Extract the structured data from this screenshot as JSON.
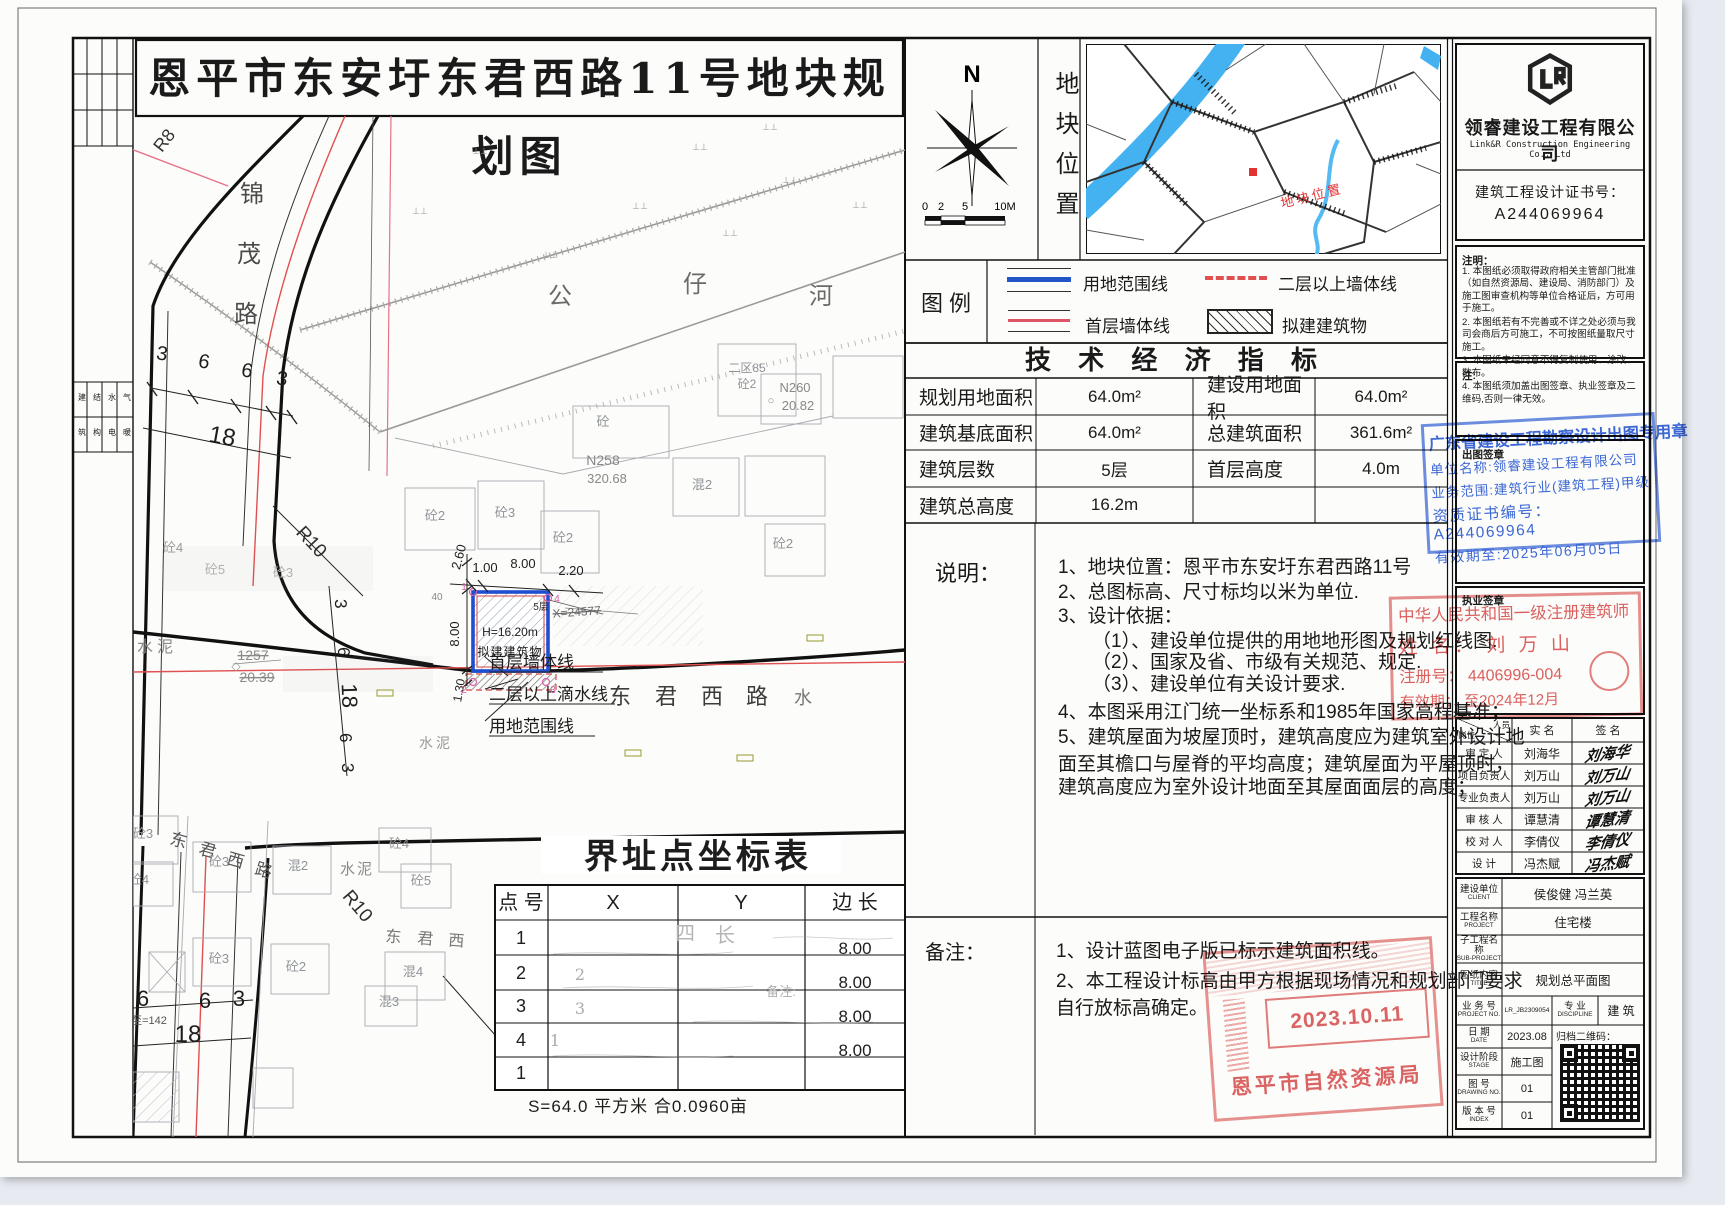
{
  "title": "恩平市东安圩东君西路11号地块规划图",
  "compass": {
    "north": "N",
    "scale_labels": [
      "0",
      "2",
      "5",
      "10M"
    ]
  },
  "location_panel": {
    "label_vertical": "地块位置",
    "marker_text": "地块位置"
  },
  "legend": {
    "title": "图  例",
    "items": [
      "用地范围线",
      "二层以上墙体线",
      "首层墙体线",
      "拟建建筑物"
    ]
  },
  "indicators": {
    "title": "技 术 经 济 指 标",
    "rows": [
      [
        "规划用地面积",
        "64.0m²",
        "建设用地面积",
        "64.0m²"
      ],
      [
        "建筑基底面积",
        "64.0m²",
        "总建筑面积",
        "361.6m²"
      ],
      [
        "建筑层数",
        "5层",
        "首层高度",
        "4.0m"
      ],
      [
        "建筑总高度",
        "16.2m",
        "",
        ""
      ]
    ]
  },
  "shuoming": {
    "label": "说明：",
    "lines": [
      "1、地块位置：恩平市东安圩东君西路11号",
      "2、总图标高、尺寸标均以米为单位.",
      "3、设计依据：",
      "（1）、建设单位提供的用地地形图及规划红线图.",
      "（2）、国家及省、市级有关规范、规定.",
      "（3）、建设单位有关设计要求.",
      "4、本图采用江门统一坐标系和1985年国家高程基准；",
      "5、建筑屋面为坡屋顶时，建筑高度应为建筑室外设计地",
      "面至其檐口与屋脊的平均高度；建筑屋面为平屋顶时，",
      "建筑高度应为室外设计地面至其屋面面层的高度；"
    ]
  },
  "beizhu": {
    "label": "备注：",
    "lines": [
      "1、设计蓝图电子版已标示建筑面积线。",
      "2、本工程设计标高由甲方根据现场情况和规划部门要求",
      "自行放标高确定。"
    ]
  },
  "company": {
    "name": "领睿建设工程有限公司",
    "name_en": "Link&R Construction Engineering Co., Ltd",
    "cert_label": "建筑工程设计证书号：",
    "cert_no": "A244069964"
  },
  "zhuming": {
    "label": "注明：",
    "lines": [
      "1. 本图纸必须取得政府相关主管部门批准（如自然资源局、建设局、消防部门）及施工图审查机构等单位合格证后，方可用于施工。",
      "2. 本图纸若有不完善或不详之处必须与我司会商后方可施工，不可按图纸量取尺寸施工。",
      "3. 本图纸未经同意不得复制使用、涂改、散布。",
      "4. 本图纸须加盖出图签章、执业签章及二维码,否则一律无效。"
    ]
  },
  "zhu": {
    "label": "注:"
  },
  "chutu": {
    "label": "出图签章",
    "stamp": [
      "广东省建设工程勘察设计出图专用章",
      "单位名称:领睿建设工程有限公司",
      "业务范围:建筑行业(建筑工程)甲级",
      "资质证书编号：A244069964",
      "有效期至:2025年06月05日"
    ]
  },
  "zhiye": {
    "label": "执业签章",
    "stamp": [
      "中华人民共和国一级注册建筑师",
      "姓 名： 刘 万 山",
      "注册号： 4406996-004",
      "有效期： 至2024年12月"
    ]
  },
  "personnel": {
    "header": {
      "pos": "岗位",
      "person": "人员",
      "name": "实 名",
      "sign": "签 名"
    },
    "rows": [
      [
        "审 定 人",
        "刘海华"
      ],
      [
        "项目负责人",
        "刘万山"
      ],
      [
        "专业负责人",
        "刘万山"
      ],
      [
        "审 核 人",
        "谭慧清"
      ],
      [
        "校 对 人",
        "李倩仪"
      ],
      [
        "设  计",
        "冯杰赋"
      ]
    ]
  },
  "project": {
    "rows": [
      {
        "zh": "建设单位",
        "en": "CLIENT",
        "val": "侯俊健  冯兰英"
      },
      {
        "zh": "工程名称",
        "en": "PROJECT",
        "val": "住宅楼"
      },
      {
        "zh": "子工程名称",
        "en": "SUB-PROJECT",
        "val": ""
      },
      {
        "zh": "图纸内容",
        "en": "TITLE",
        "val": "规划总平面图"
      }
    ],
    "no_zh": "业 务 号",
    "no_en": "PROJECT NO.",
    "no_val": "LR_JB2309054",
    "disc_zh": "专  业",
    "disc_en": "DISCIPLINE",
    "disc_val": "建  筑",
    "date_zh": "日  期",
    "date_en": "DATE",
    "date_val": "2023.08",
    "qr_label": "归档二维码：",
    "stage_zh": "设计阶段",
    "stage_en": "STAGE",
    "stage_val": "施工图",
    "dwg_zh": "图  号",
    "dwg_en": "DRAWING NO.",
    "dwg_val": "01",
    "idx_zh": "版 本 号",
    "idx_en": "INDEX",
    "idx_val": "01"
  },
  "approval_stamp": {
    "date": "2023.10.11",
    "org": "恩平市自然资源局"
  },
  "margin_strip": {
    "chars": [
      [
        "建",
        "筑"
      ],
      [
        "结",
        "构"
      ],
      [
        "水",
        "电"
      ],
      [
        "气",
        "暖"
      ]
    ]
  },
  "coord_table": {
    "title": "界址点坐标表",
    "headers": [
      "点 号",
      "X",
      "Y",
      "边 长"
    ],
    "points": [
      "1",
      "2",
      "3",
      "4",
      "1"
    ],
    "lengths": [
      "8.00",
      "8.00",
      "8.00",
      "8.00"
    ],
    "ghost_x": [
      "2",
      "3",
      "1"
    ],
    "ghost_marks": [
      "四",
      "长",
      "备注:"
    ],
    "footer": "S=64.0 平方米 合0.0960亩"
  },
  "map": {
    "labels": [
      {
        "t": "锦",
        "x": 119,
        "y": 86,
        "s": 24,
        "c": "#4a4a4a"
      },
      {
        "t": "茂",
        "x": 116,
        "y": 146,
        "s": 24,
        "c": "#4a4a4a"
      },
      {
        "t": "路",
        "x": 113,
        "y": 206,
        "s": 24,
        "c": "#4a4a4a"
      },
      {
        "t": "R8",
        "x": 36,
        "y": 28,
        "s": 18,
        "r": -52,
        "c": "#333333"
      },
      {
        "t": "公",
        "x": 427,
        "y": 188,
        "s": 24,
        "c": "#6a6a6a"
      },
      {
        "t": "仔",
        "x": 562,
        "y": 176,
        "s": 24,
        "c": "#6a6a6a"
      },
      {
        "t": "河",
        "x": 688,
        "y": 188,
        "s": 24,
        "c": "#6a6a6a"
      },
      {
        "t": "R10",
        "x": 174,
        "y": 430,
        "s": 19,
        "r": 47,
        "c": "#2e2e2e"
      },
      {
        "t": "R10",
        "x": 220,
        "y": 794,
        "s": 19,
        "r": 50,
        "c": "#2e2e2e"
      },
      {
        "t": "3",
        "x": 28,
        "y": 244,
        "s": 20,
        "r": 10
      },
      {
        "t": "6",
        "x": 70,
        "y": 252,
        "s": 20,
        "r": 10
      },
      {
        "t": "6",
        "x": 113,
        "y": 261,
        "s": 20,
        "r": 10
      },
      {
        "t": "3",
        "x": 148,
        "y": 269,
        "s": 20,
        "r": 10
      },
      {
        "t": "18",
        "x": 88,
        "y": 328,
        "s": 24,
        "r": 10
      },
      {
        "t": "3",
        "x": 202,
        "y": 488,
        "s": 17,
        "r": 88
      },
      {
        "t": "6",
        "x": 205,
        "y": 536,
        "s": 17,
        "r": 88
      },
      {
        "t": "18",
        "x": 209,
        "y": 580,
        "s": 22,
        "r": 88
      },
      {
        "t": "6",
        "x": 207,
        "y": 622,
        "s": 17,
        "r": 88
      },
      {
        "t": "3",
        "x": 209,
        "y": 652,
        "s": 17,
        "r": 88
      },
      {
        "t": "6",
        "x": 10,
        "y": 890,
        "s": 22
      },
      {
        "t": "6",
        "x": 72,
        "y": 892,
        "s": 22
      },
      {
        "t": "3",
        "x": 106,
        "y": 890,
        "s": 22
      },
      {
        "t": "18",
        "x": 55,
        "y": 926,
        "s": 24
      },
      {
        "t": "至=142",
        "x": 16,
        "y": 908,
        "s": 11,
        "c": "#555555"
      },
      {
        "t": "东",
        "x": 487,
        "y": 588,
        "s": 22,
        "c": "#3c3c3c"
      },
      {
        "t": "君",
        "x": 533,
        "y": 588,
        "s": 22,
        "c": "#3c3c3c"
      },
      {
        "t": "西",
        "x": 579,
        "y": 588,
        "s": 22,
        "c": "#3c3c3c"
      },
      {
        "t": "路",
        "x": 624,
        "y": 588,
        "s": 22,
        "c": "#3c3c3c"
      },
      {
        "t": "水",
        "x": 670,
        "y": 588,
        "s": 18,
        "c": "#777777"
      },
      {
        "t": "东",
        "x": 44,
        "y": 730,
        "s": 17,
        "r": 16,
        "c": "#555555"
      },
      {
        "t": "君",
        "x": 73,
        "y": 740,
        "s": 17,
        "r": 16,
        "c": "#555555"
      },
      {
        "t": "西",
        "x": 101,
        "y": 750,
        "s": 17,
        "r": 16,
        "c": "#555555"
      },
      {
        "t": "路",
        "x": 129,
        "y": 760,
        "s": 17,
        "r": 16,
        "c": "#555555"
      },
      {
        "t": "东",
        "x": 260,
        "y": 826,
        "s": 16,
        "r": 4,
        "c": "#777777"
      },
      {
        "t": "君",
        "x": 292,
        "y": 828,
        "s": 16,
        "r": 4,
        "c": "#777777"
      },
      {
        "t": "西",
        "x": 323,
        "y": 830,
        "s": 16,
        "r": 4,
        "c": "#777777"
      },
      {
        "t": "1257",
        "x": 120,
        "y": 544,
        "s": 14,
        "c": "#8a8a8a",
        "td": 1
      },
      {
        "t": "20.39",
        "x": 124,
        "y": 566,
        "s": 14,
        "c": "#8a8a8a",
        "td": 1
      },
      {
        "t": "◇",
        "x": 103,
        "y": 554,
        "s": 12,
        "c": "#999999"
      },
      {
        "t": "水泥",
        "x": 24,
        "y": 536,
        "s": 16,
        "c": "#8a8a8a",
        "ls": 4
      },
      {
        "t": "水泥",
        "x": 303,
        "y": 632,
        "s": 14,
        "c": "#9a9a9a",
        "ls": 3
      },
      {
        "t": "水泥",
        "x": 224,
        "y": 758,
        "s": 15,
        "c": "#8a8a8a",
        "ls": 2
      },
      {
        "t": "砼2",
        "x": 302,
        "y": 404,
        "s": 13,
        "c": "#8f9398"
      },
      {
        "t": "砼3",
        "x": 372,
        "y": 401,
        "s": 13,
        "c": "#8f9398"
      },
      {
        "t": "砼2",
        "x": 430,
        "y": 426,
        "s": 13,
        "c": "#8f9398"
      },
      {
        "t": "混2",
        "x": 569,
        "y": 373,
        "s": 13,
        "c": "#8f9398"
      },
      {
        "t": "砼2",
        "x": 650,
        "y": 432,
        "s": 13,
        "c": "#8f9398"
      },
      {
        "t": "砼",
        "x": 470,
        "y": 310,
        "s": 13,
        "c": "#8f9398"
      },
      {
        "t": "二区85",
        "x": 614,
        "y": 256,
        "s": 12,
        "c": "#8f9398"
      },
      {
        "t": "砼2",
        "x": 614,
        "y": 272,
        "s": 12,
        "c": "#8f9398"
      },
      {
        "t": "N260",
        "x": 662,
        "y": 276,
        "s": 13,
        "c": "#888888"
      },
      {
        "t": "20.82",
        "x": 665,
        "y": 294,
        "s": 13,
        "c": "#888888"
      },
      {
        "t": "○",
        "x": 638,
        "y": 288,
        "s": 11,
        "c": "#888888"
      },
      {
        "t": "N258",
        "x": 470,
        "y": 349,
        "s": 14,
        "c": "#888888"
      },
      {
        "t": "320.68",
        "x": 474,
        "y": 367,
        "s": 13,
        "c": "#888888"
      },
      {
        "t": "砼5",
        "x": 82,
        "y": 458,
        "s": 13,
        "c": "#b0b0b0"
      },
      {
        "t": "砼3",
        "x": 150,
        "y": 461,
        "s": 13,
        "c": "#b0b0b0"
      },
      {
        "t": "砼4",
        "x": 40,
        "y": 436,
        "s": 13,
        "c": "#9a9a9a"
      },
      {
        "t": "砼3",
        "x": 10,
        "y": 722,
        "s": 13,
        "c": "#8f9398"
      },
      {
        "t": "砼3",
        "x": 86,
        "y": 750,
        "s": 13,
        "c": "#8f9398"
      },
      {
        "t": "砼4",
        "x": 6,
        "y": 768,
        "s": 13,
        "c": "#8f9398"
      },
      {
        "t": "混2",
        "x": 165,
        "y": 754,
        "s": 13,
        "c": "#8f9398"
      },
      {
        "t": "砼4",
        "x": 266,
        "y": 732,
        "s": 13,
        "c": "#8f9398"
      },
      {
        "t": "砼5",
        "x": 288,
        "y": 769,
        "s": 13,
        "c": "#8f9398"
      },
      {
        "t": "砼3",
        "x": 86,
        "y": 847,
        "s": 13,
        "c": "#8f9398"
      },
      {
        "t": "砼2",
        "x": 163,
        "y": 855,
        "s": 13,
        "c": "#8f9398"
      },
      {
        "t": "混4",
        "x": 280,
        "y": 860,
        "s": 13,
        "c": "#8f9398"
      },
      {
        "t": "混3",
        "x": 256,
        "y": 890,
        "s": 13,
        "c": "#8f9398"
      },
      {
        "t": "5层",
        "x": 408,
        "y": 494,
        "s": 10,
        "c": "#333333"
      },
      {
        "t": "H=16.20m",
        "x": 377,
        "y": 520,
        "s": 12
      },
      {
        "t": "拟建建筑物",
        "x": 377,
        "y": 540,
        "s": 12,
        "ls": 1
      },
      {
        "t": "2.60",
        "x": 330,
        "y": 442,
        "s": 13,
        "r": -75
      },
      {
        "t": "1.00",
        "x": 352,
        "y": 456,
        "s": 13
      },
      {
        "t": "8.00",
        "x": 390,
        "y": 452,
        "s": 13
      },
      {
        "t": "2.20",
        "x": 438,
        "y": 459,
        "s": 13
      },
      {
        "t": "8.00",
        "x": 326,
        "y": 518,
        "s": 13,
        "r": -90
      },
      {
        "t": "1.30",
        "x": 330,
        "y": 575,
        "s": 12,
        "r": -80
      },
      {
        "t": "40",
        "x": 304,
        "y": 484,
        "s": 10,
        "c": "#888888"
      },
      {
        "t": "X=24577",
        "x": 444,
        "y": 500,
        "s": 12,
        "c": "#6a6a6a",
        "td": 1,
        "r": -4
      },
      {
        "t": "首层墙体线",
        "x": 356,
        "y": 552,
        "s": 17,
        "a": "s"
      },
      {
        "t": "二层以上滴水线",
        "x": 356,
        "y": 584,
        "s": 17,
        "a": "s"
      },
      {
        "t": "用地范围线",
        "x": 356,
        "y": 616,
        "s": 17,
        "a": "s"
      },
      {
        "t": "1",
        "x": 331,
        "y": 474,
        "s": 10,
        "c": "#d660a8"
      },
      {
        "t": "4",
        "x": 424,
        "y": 486,
        "s": 10,
        "c": "#d660a8"
      },
      {
        "t": "2",
        "x": 331,
        "y": 577,
        "s": 10,
        "c": "#d660a8"
      },
      {
        "t": "3",
        "x": 420,
        "y": 577,
        "s": 10,
        "c": "#d660a8"
      },
      {
        "t": "⊥⊥",
        "x": 347,
        "y": 38,
        "s": 9,
        "c": "#999999"
      },
      {
        "t": "⊥⊥",
        "x": 567,
        "y": 34,
        "s": 9,
        "c": "#999999"
      },
      {
        "t": "⊥⊥",
        "x": 637,
        "y": 14,
        "s": 9,
        "c": "#999999"
      },
      {
        "t": "⊥⊥",
        "x": 287,
        "y": 98,
        "s": 9,
        "c": "#999999"
      },
      {
        "t": "⊥⊥",
        "x": 507,
        "y": 93,
        "s": 9,
        "c": "#999999"
      },
      {
        "t": "⊥⊥",
        "x": 657,
        "y": 67,
        "s": 9,
        "c": "#999999"
      },
      {
        "t": "⊥⊥",
        "x": 727,
        "y": 92,
        "s": 9,
        "c": "#999999"
      },
      {
        "t": "⊥⊥",
        "x": 417,
        "y": 142,
        "s": 9,
        "c": "#999999"
      },
      {
        "t": "⊥⊥",
        "x": 597,
        "y": 120,
        "s": 9,
        "c": "#999999"
      }
    ]
  }
}
